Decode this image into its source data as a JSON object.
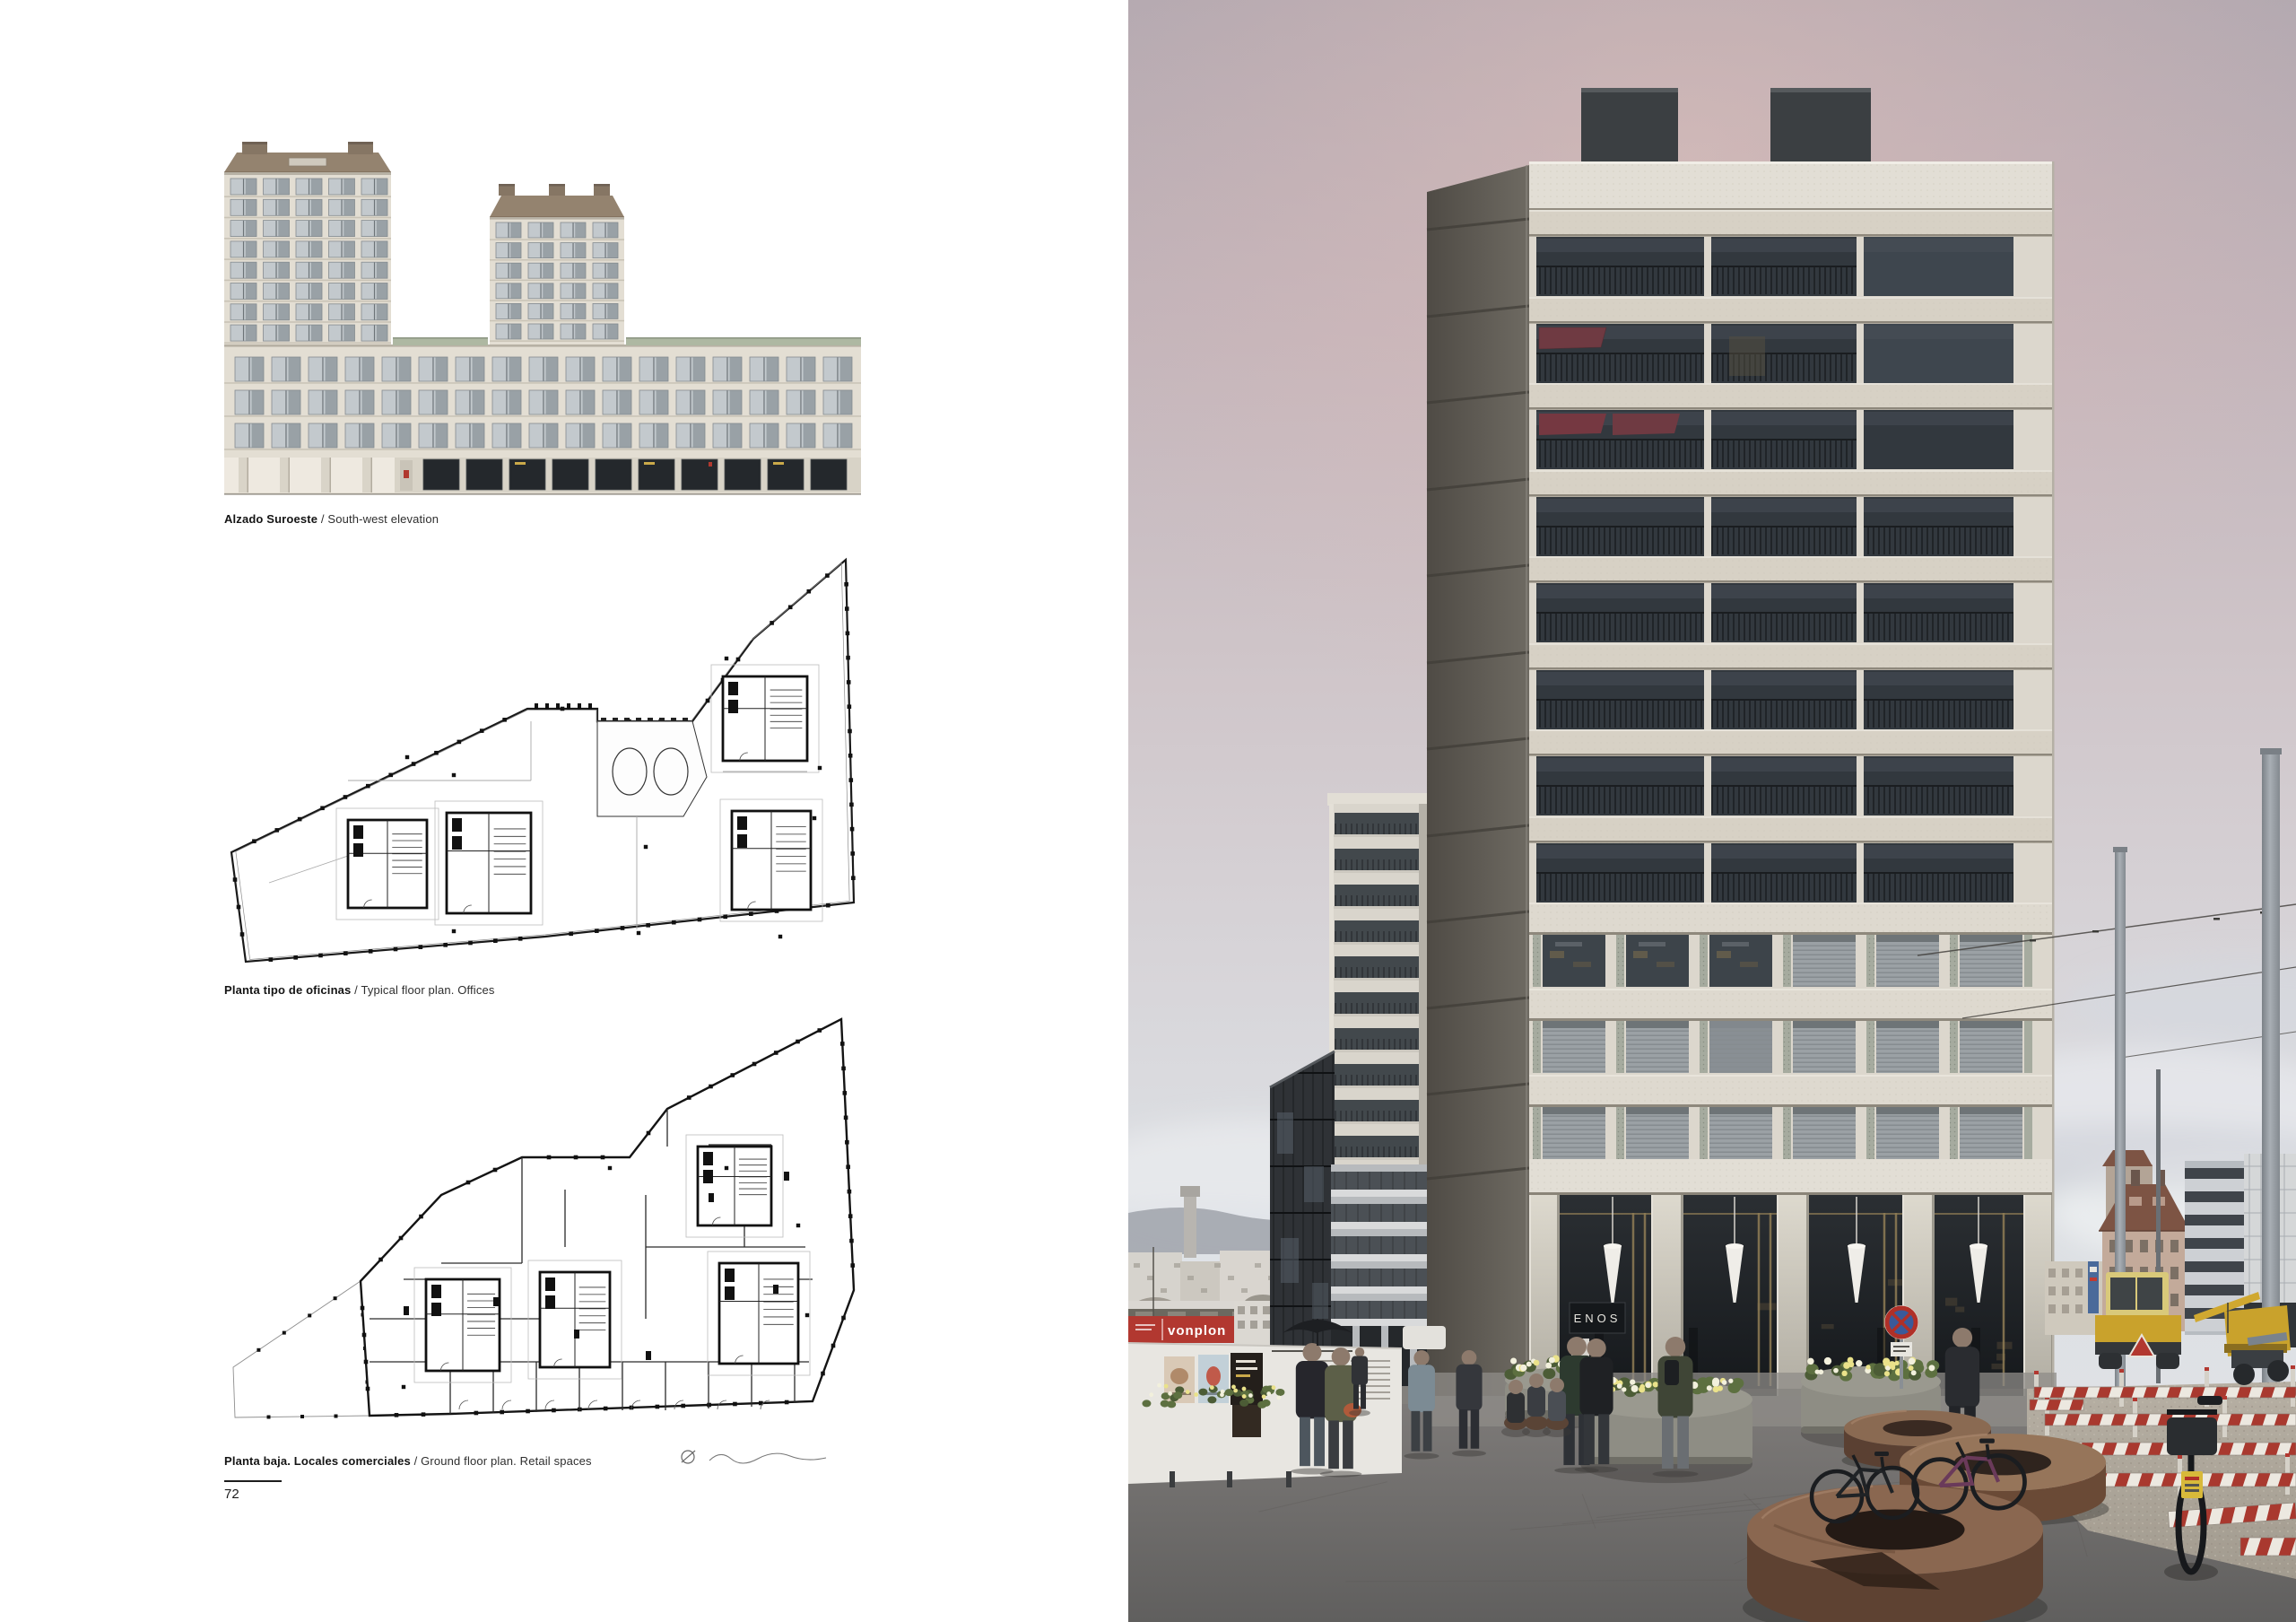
{
  "page": {
    "number": "72",
    "figures": [
      {
        "caption_es": "Alzado Suroeste",
        "caption_sep": " / ",
        "caption_en": "South-west elevation"
      },
      {
        "caption_es": "Planta tipo de oficinas",
        "caption_sep": " / ",
        "caption_en": "Typical floor plan. Offices"
      },
      {
        "caption_es": "Planta baja. Locales comerciales",
        "caption_sep": " / ",
        "caption_en": "Ground floor plan. Retail spaces"
      }
    ]
  },
  "photo": {
    "signs": {
      "container": "vonplon",
      "storefront": "ENOS"
    },
    "colors": {
      "facade": "#dcd7cd",
      "awning": "#6f3a42",
      "glass": "#32383e",
      "container_red": "#b23830",
      "barrier_red": "#a9392f",
      "machine_yellow": "#c9a22c",
      "asphalt": "#6b6968"
    }
  }
}
